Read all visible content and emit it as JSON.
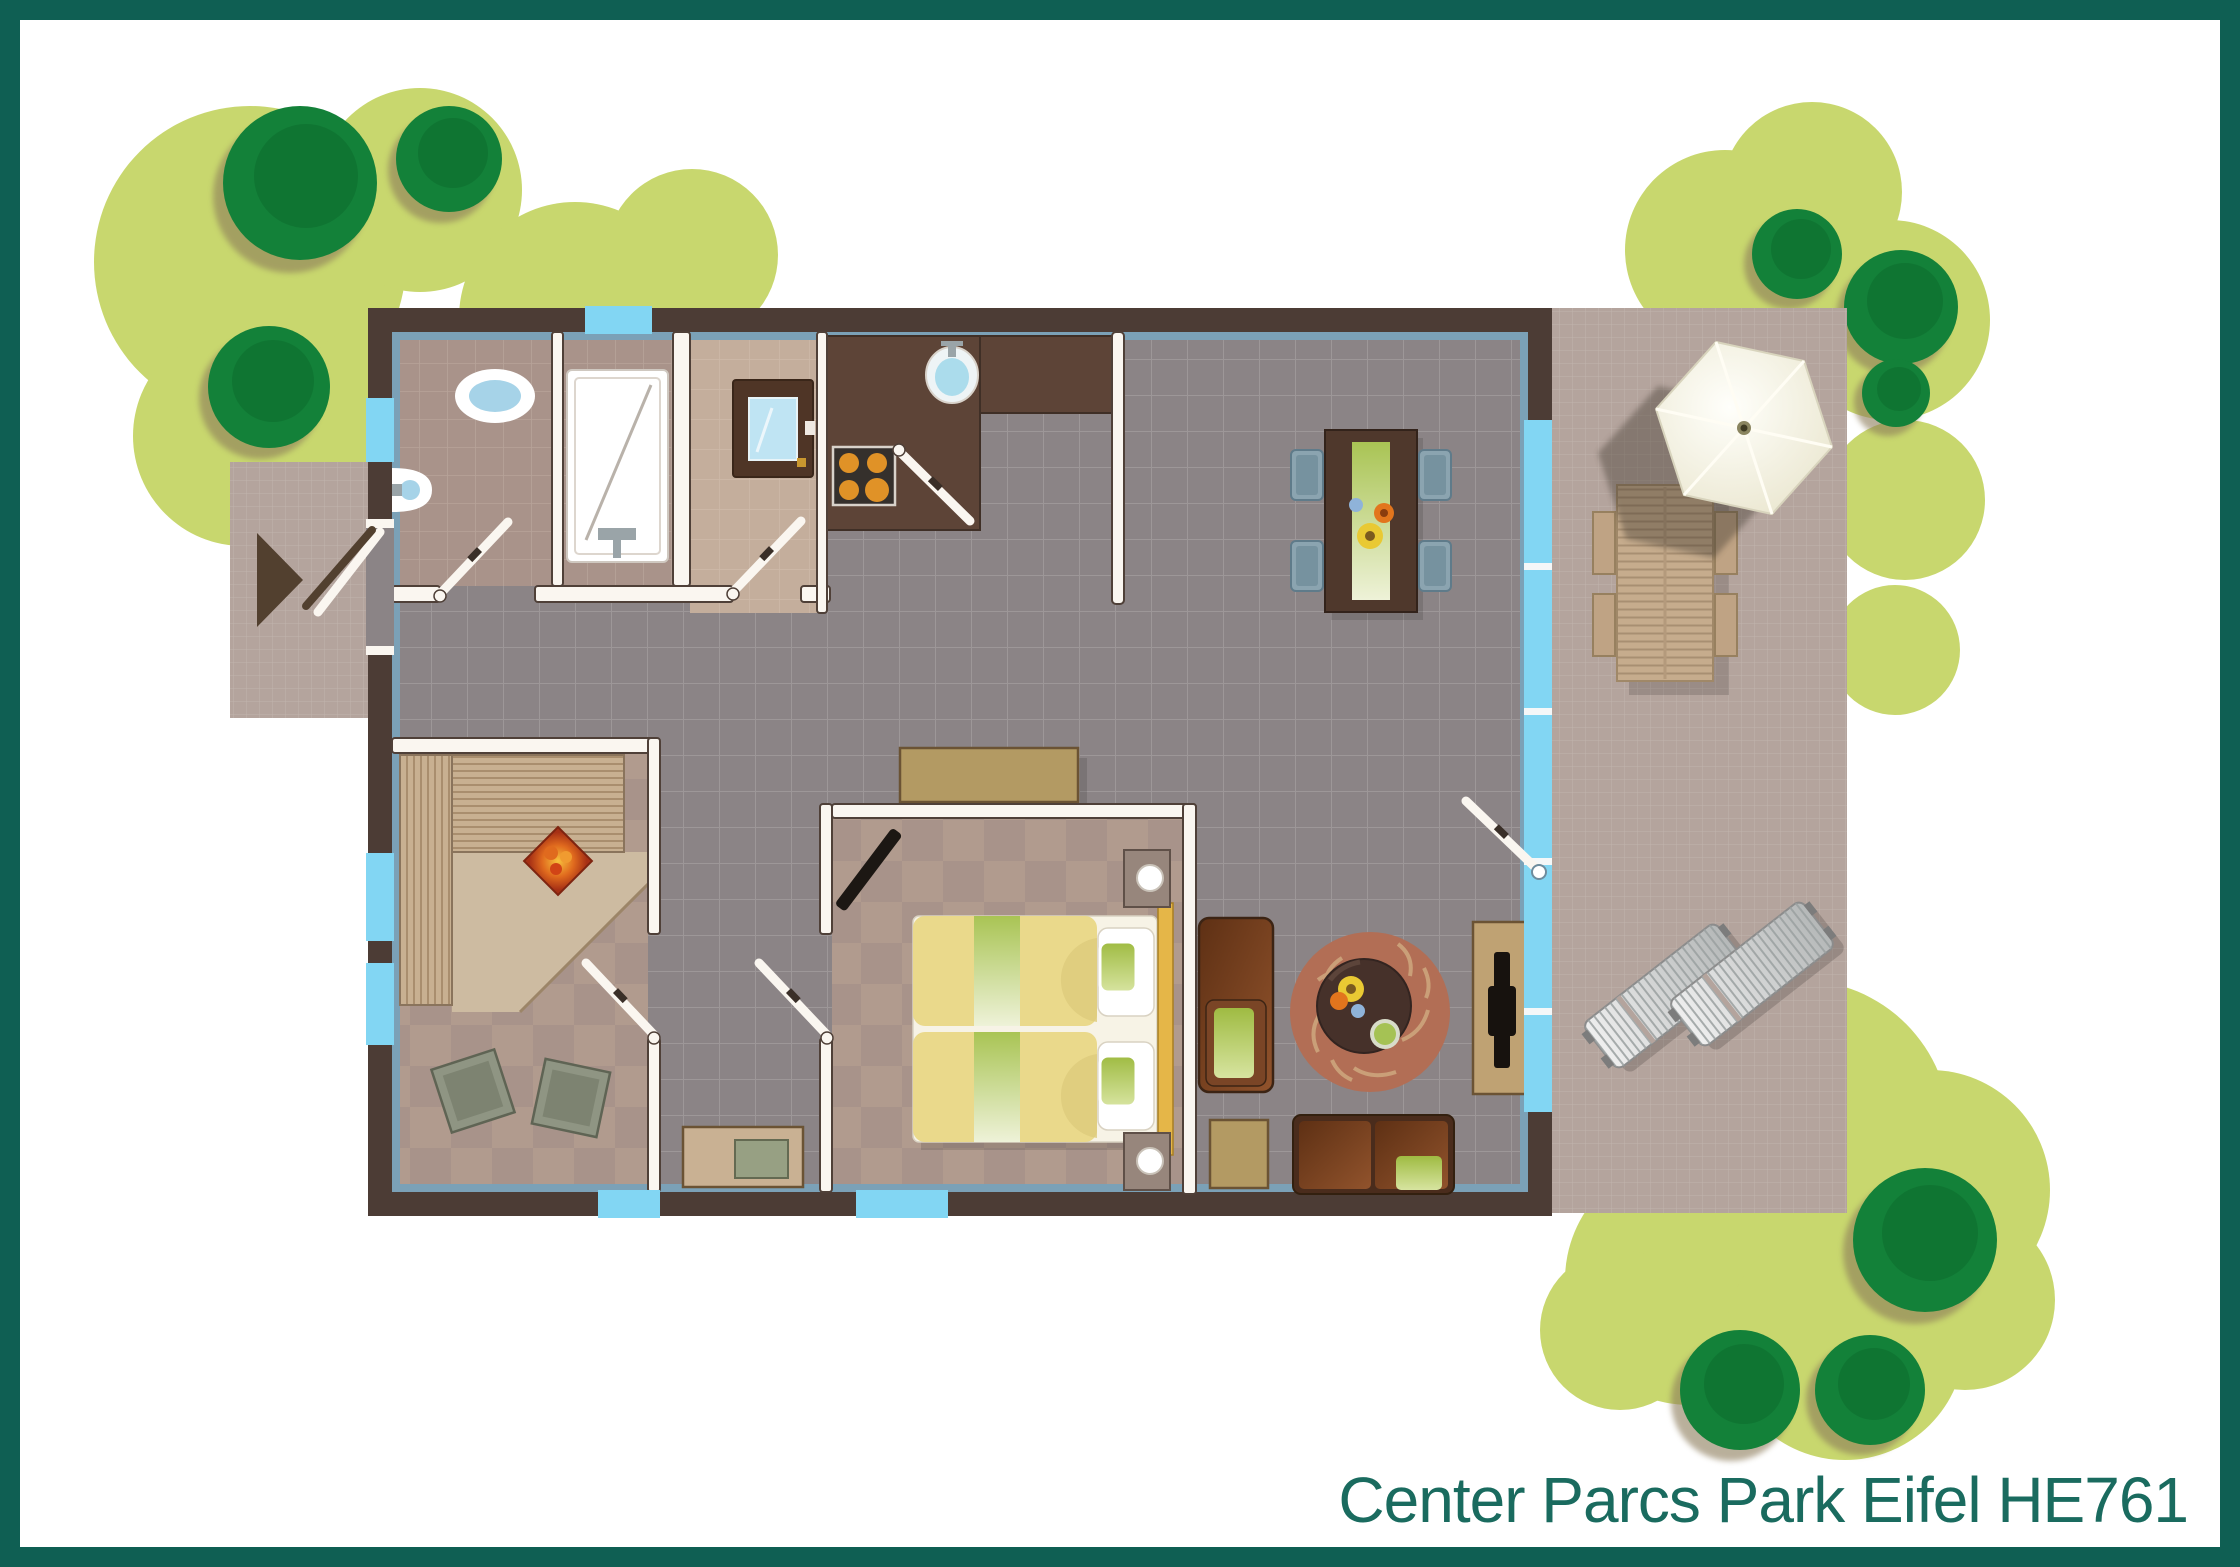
{
  "title": {
    "text": "Center Parcs Park Eifel HE761",
    "color": "#1a6b5f"
  },
  "frame": {
    "border_color": "#0f5f53",
    "background": "#ffffff"
  },
  "palette": {
    "garden_green": "#c8d76e",
    "tree_green": "#138139",
    "tree_shadow": "#8c7b5a",
    "house_wall": "#4c3c35",
    "wall_liner": "#7ba1b7",
    "interior_wall": "#faf6f0",
    "hall_floor": "#8b8486",
    "bathroom_floor": "#a9938a",
    "checker_floor_a": "#a8938a",
    "checker_floor_b": "#b19b8e",
    "utility_floor": "#c4ae9c",
    "terrace_floor": "#b4a49d",
    "window_glass": "#82d6f3",
    "kitchen_counter": "#5d4437",
    "bed_yellow": "#ead98b",
    "accent_green": "#a9c454",
    "sofa_brown": "#7a4526",
    "rug_terracotta": "#b26e55",
    "umbrella_cream": "#f2efdd",
    "sauna_heater_red": "#b5381c",
    "wood_tan": "#c6ac8d"
  },
  "plan": {
    "type": "holiday-cottage-floorplan",
    "objects": [
      "entrance-arrow",
      "entrance-door",
      "toilet",
      "corner-sink",
      "shower-tray",
      "glass-door-appliance",
      "kitchen-counter",
      "stove-4-burners",
      "kitchen-sink",
      "dining-table",
      "dining-chairs",
      "flower-decoration",
      "sideboard",
      "double-bed",
      "pillows",
      "nightstand-lamps",
      "wall-tv",
      "armchair",
      "coffee-table",
      "round-rug",
      "tv-cabinet",
      "sofa",
      "side-table",
      "sauna-bench",
      "sauna-heater",
      "poufs",
      "corridor-dresser",
      "glass-wall",
      "terrace",
      "parasol",
      "picnic-table",
      "sun-loungers",
      "garden-trees"
    ]
  }
}
